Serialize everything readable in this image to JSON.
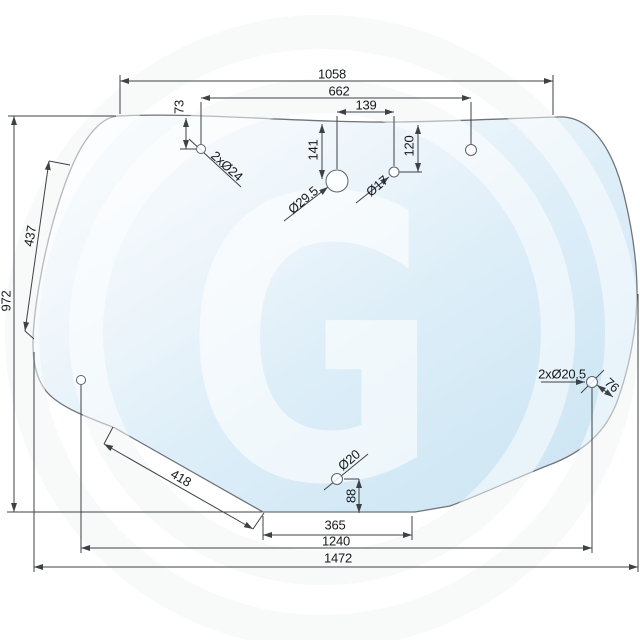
{
  "drawing": {
    "watermark": "G",
    "dims": {
      "top_width": "1058",
      "top_hole_span": "662",
      "center_hole_gap": "139",
      "top_hole_drop": "73",
      "top_hole_dia": "2xØ24",
      "big_hole_drop": "141",
      "big_hole_dia": "Ø29.5",
      "small_hole_dia": "Ø17",
      "small_hole_drop": "120",
      "left_upper_edge": "437",
      "overall_height": "972",
      "left_lower_edge": "418",
      "bottom_hole_dia": "Ø20",
      "bottom_hole_rise": "88",
      "bottom_edge": "365",
      "bottom_hole_span": "1240",
      "overall_width": "1472",
      "side_hole_dia": "2xØ20.5",
      "side_hole_inset": "76"
    },
    "colors": {
      "glass_light": "#fbfdfe",
      "glass_dark": "#cbe3f2",
      "line": "#3d4246"
    }
  }
}
